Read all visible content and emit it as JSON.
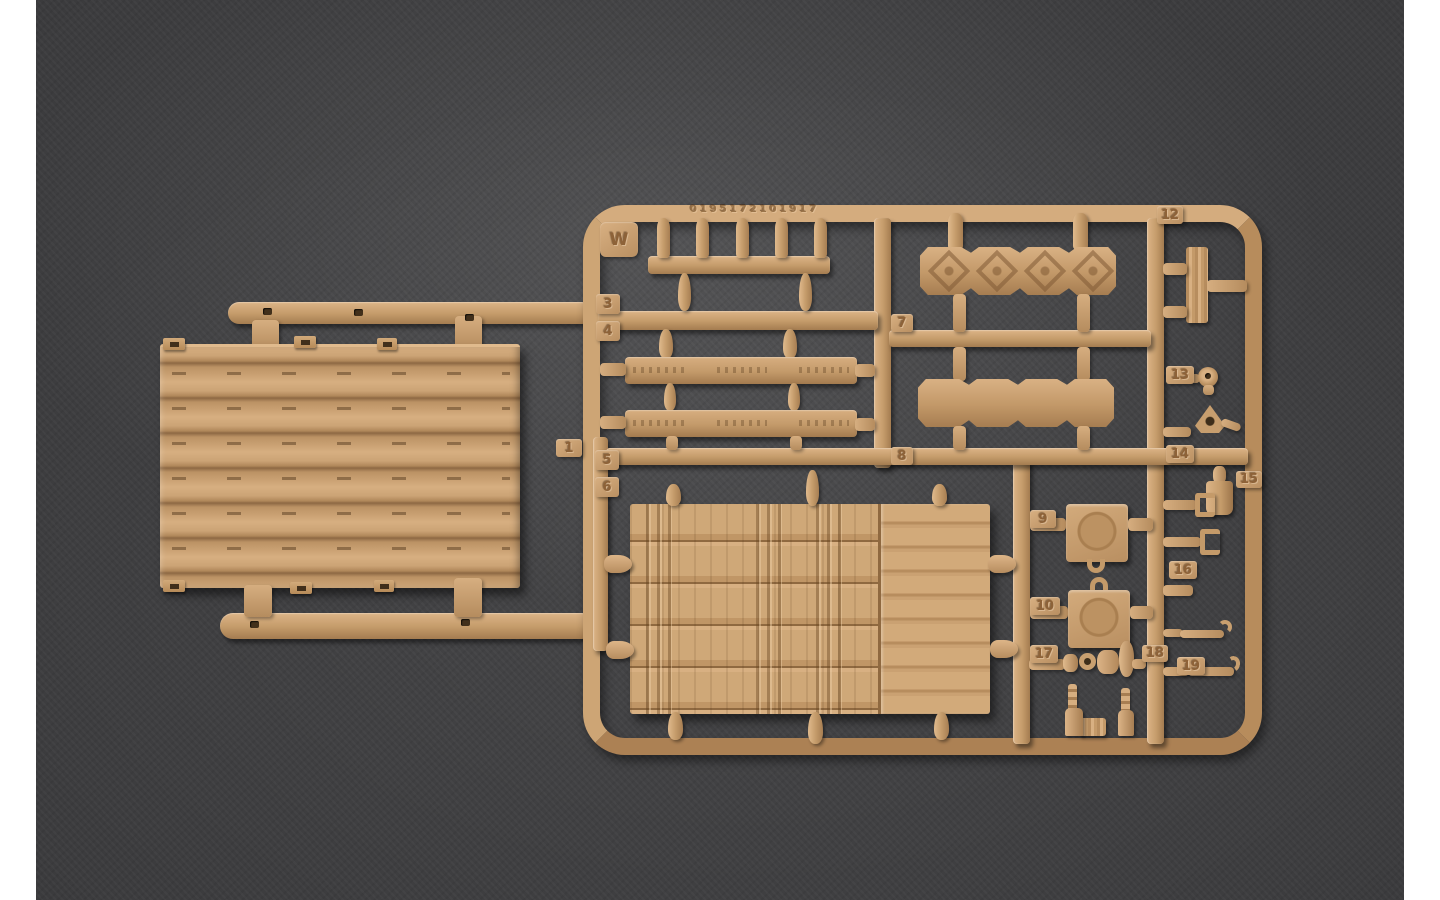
{
  "photo": {
    "subject": "tan plastic model-kit sprue on dark felt",
    "colors": {
      "plastic": "#c79f6e",
      "plastic_highlight": "#dcb487",
      "plastic_shadow": "#a47c50",
      "felt_background": "#3c3c3e",
      "photo_margin": "#ffffff"
    },
    "sprue": {
      "letter": "W",
      "mold_text": "0195172101917",
      "tags": {
        "n1": "1",
        "n3": "3",
        "n4": "4",
        "n5": "5",
        "n6": "6",
        "n7": "7",
        "n8": "8",
        "n9": "9",
        "n10": "10",
        "n12": "12",
        "n13": "13",
        "n14": "14",
        "n15": "15",
        "n16": "16",
        "n17": "17",
        "n18": "18",
        "n19": "19"
      }
    }
  }
}
